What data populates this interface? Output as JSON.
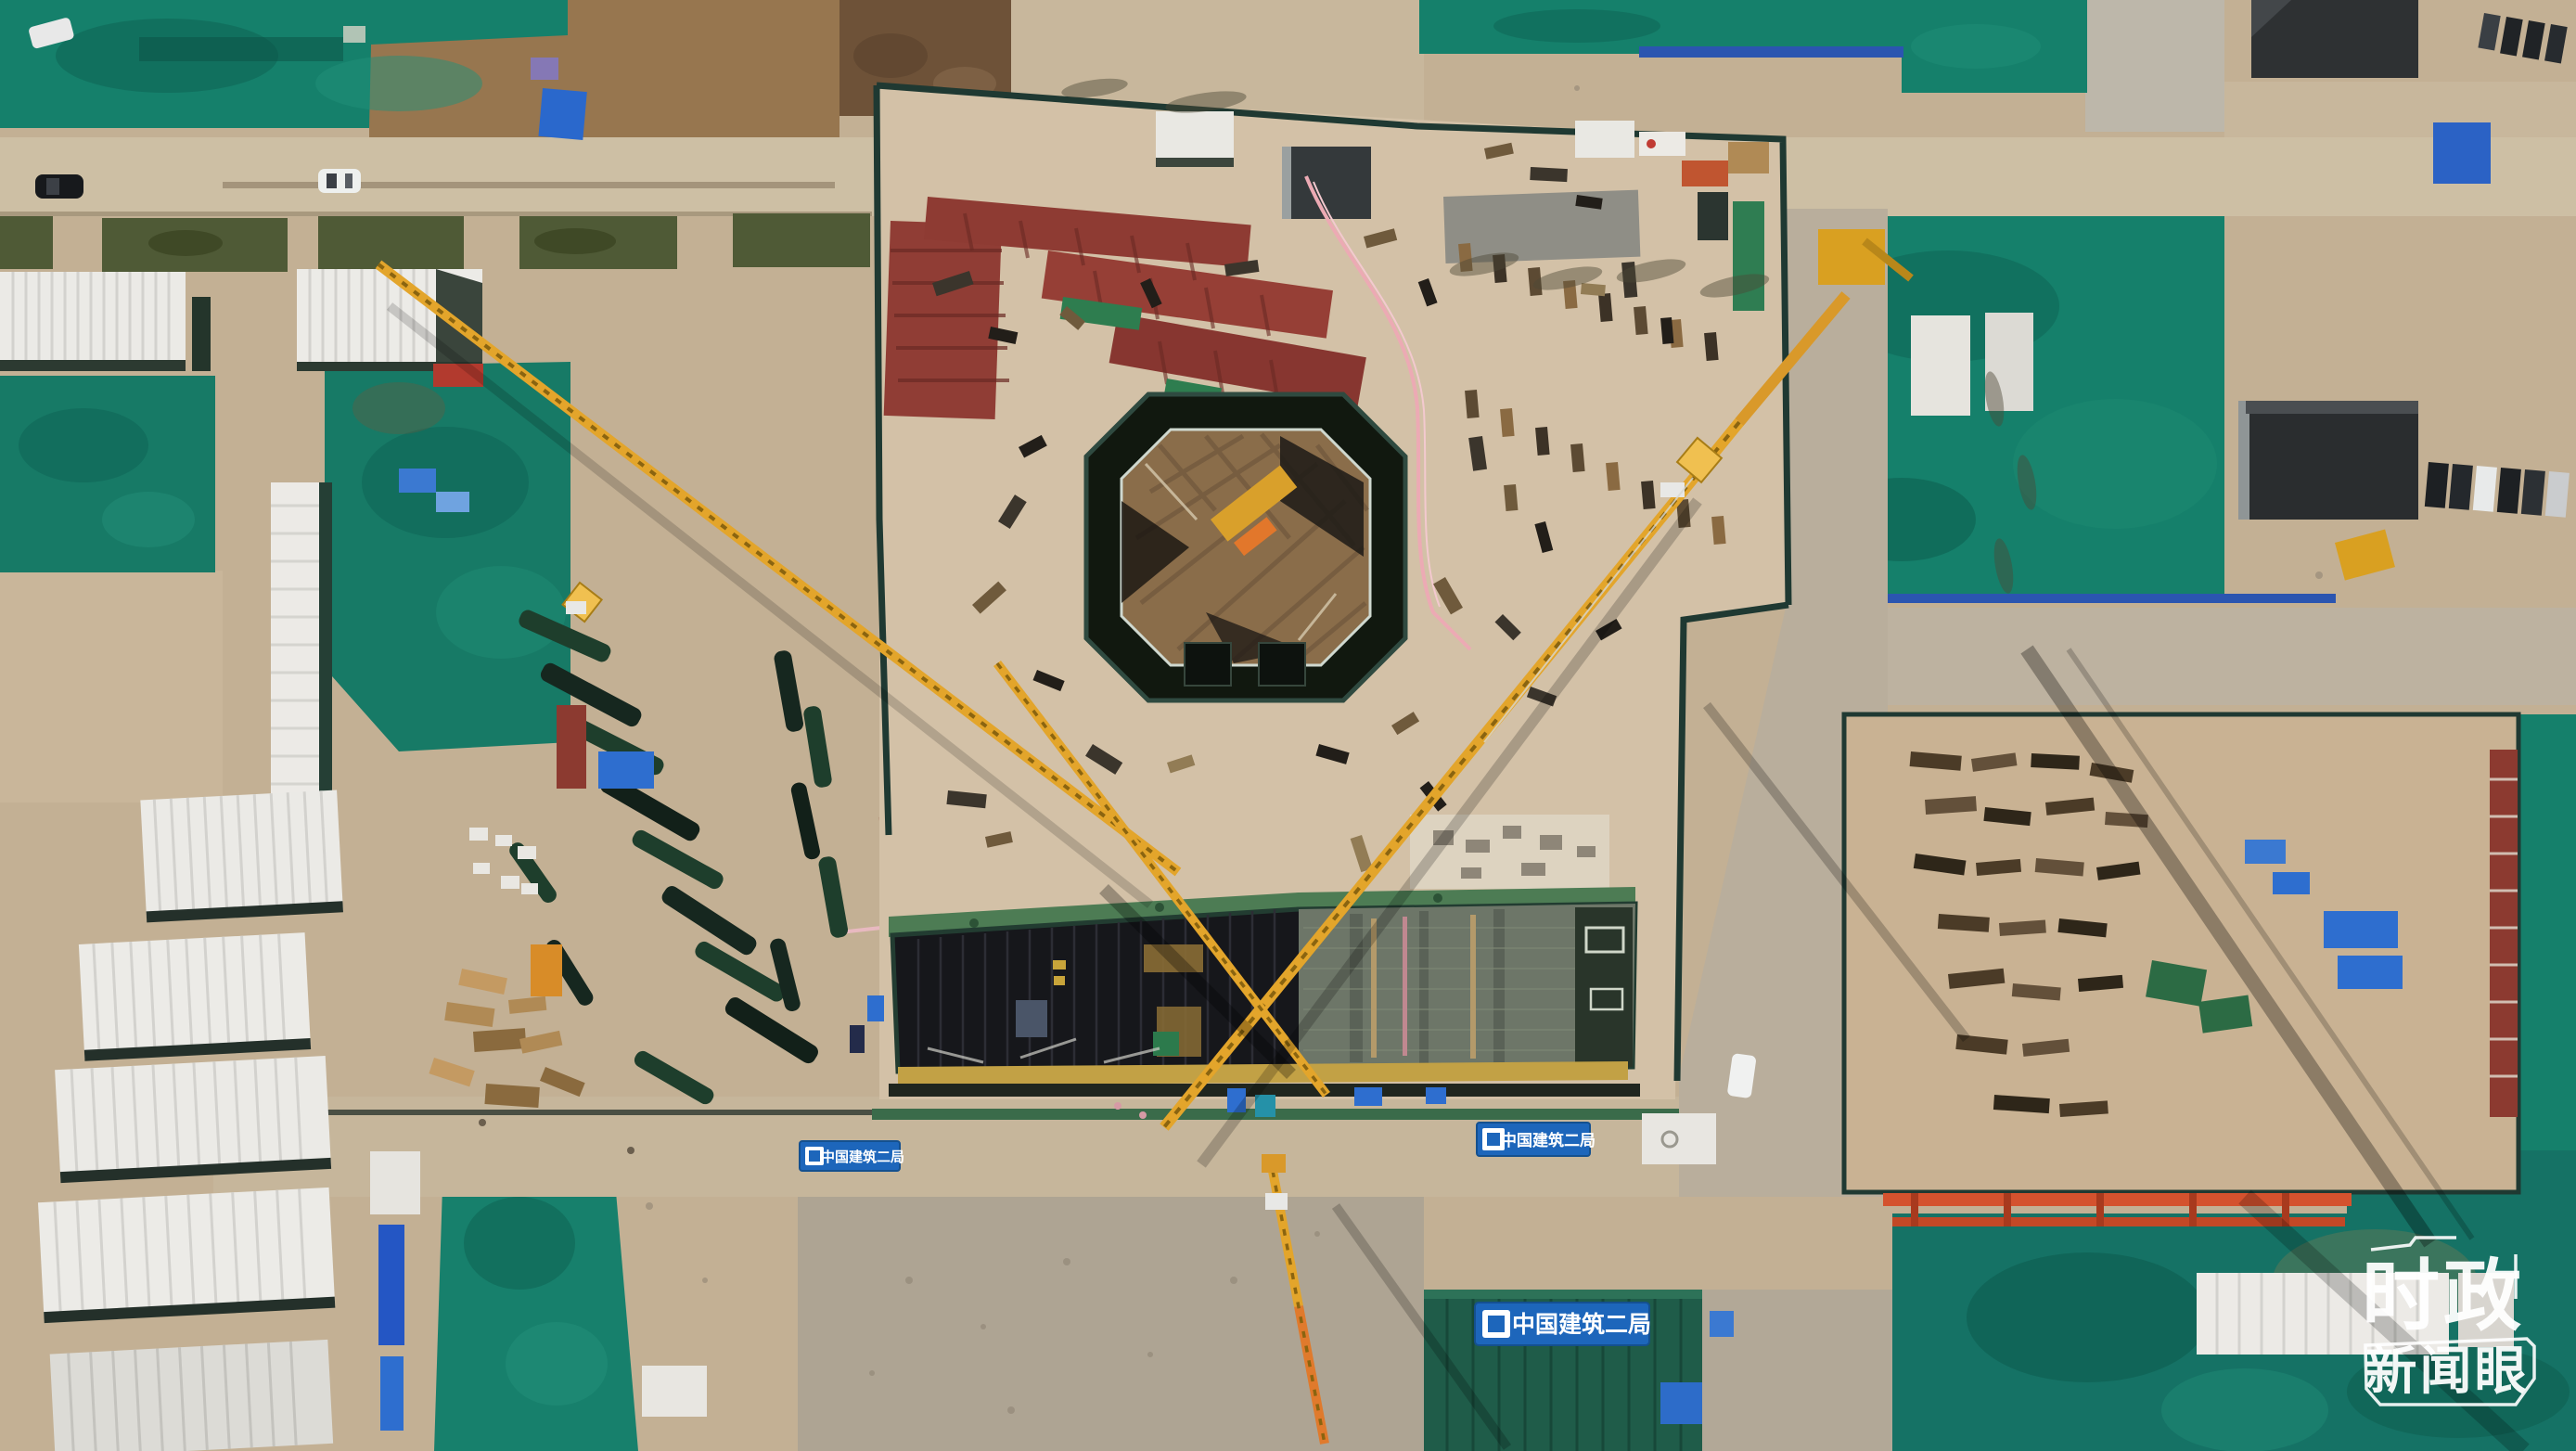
{
  "watermark": {
    "line1": "时政",
    "line2": "新闻眼",
    "text_color": "#ffffff"
  },
  "signs": {
    "banner_label": "中国建筑二局",
    "banner_background": "#1d66bb",
    "banner_text_color": "#ffffff"
  },
  "palette": {
    "ground_tan": "#c3b094",
    "pit_floor_tan": "#d3c1a7",
    "road_gray": "#b9ae9c",
    "concrete_gray": "#aea493",
    "net_green": "#15806b",
    "net_green_dark": "#0e6253",
    "fence_dark_green": "#1f3932",
    "walkway_moss": "#4d7c54",
    "hedge_olive": "#4f5a36",
    "container_white": "#ebeae6",
    "shed_maroon": "#8e3b33",
    "crane_yellow": "#e3a52b",
    "machine_orange": "#e07a2c",
    "excavation_black": "#16171b",
    "rebar_gray_green": "#6d7668",
    "timber_brown": "#8c6e4b",
    "tarp_blue": "#2e6ecf",
    "banner_blue": "#1d66bb"
  }
}
